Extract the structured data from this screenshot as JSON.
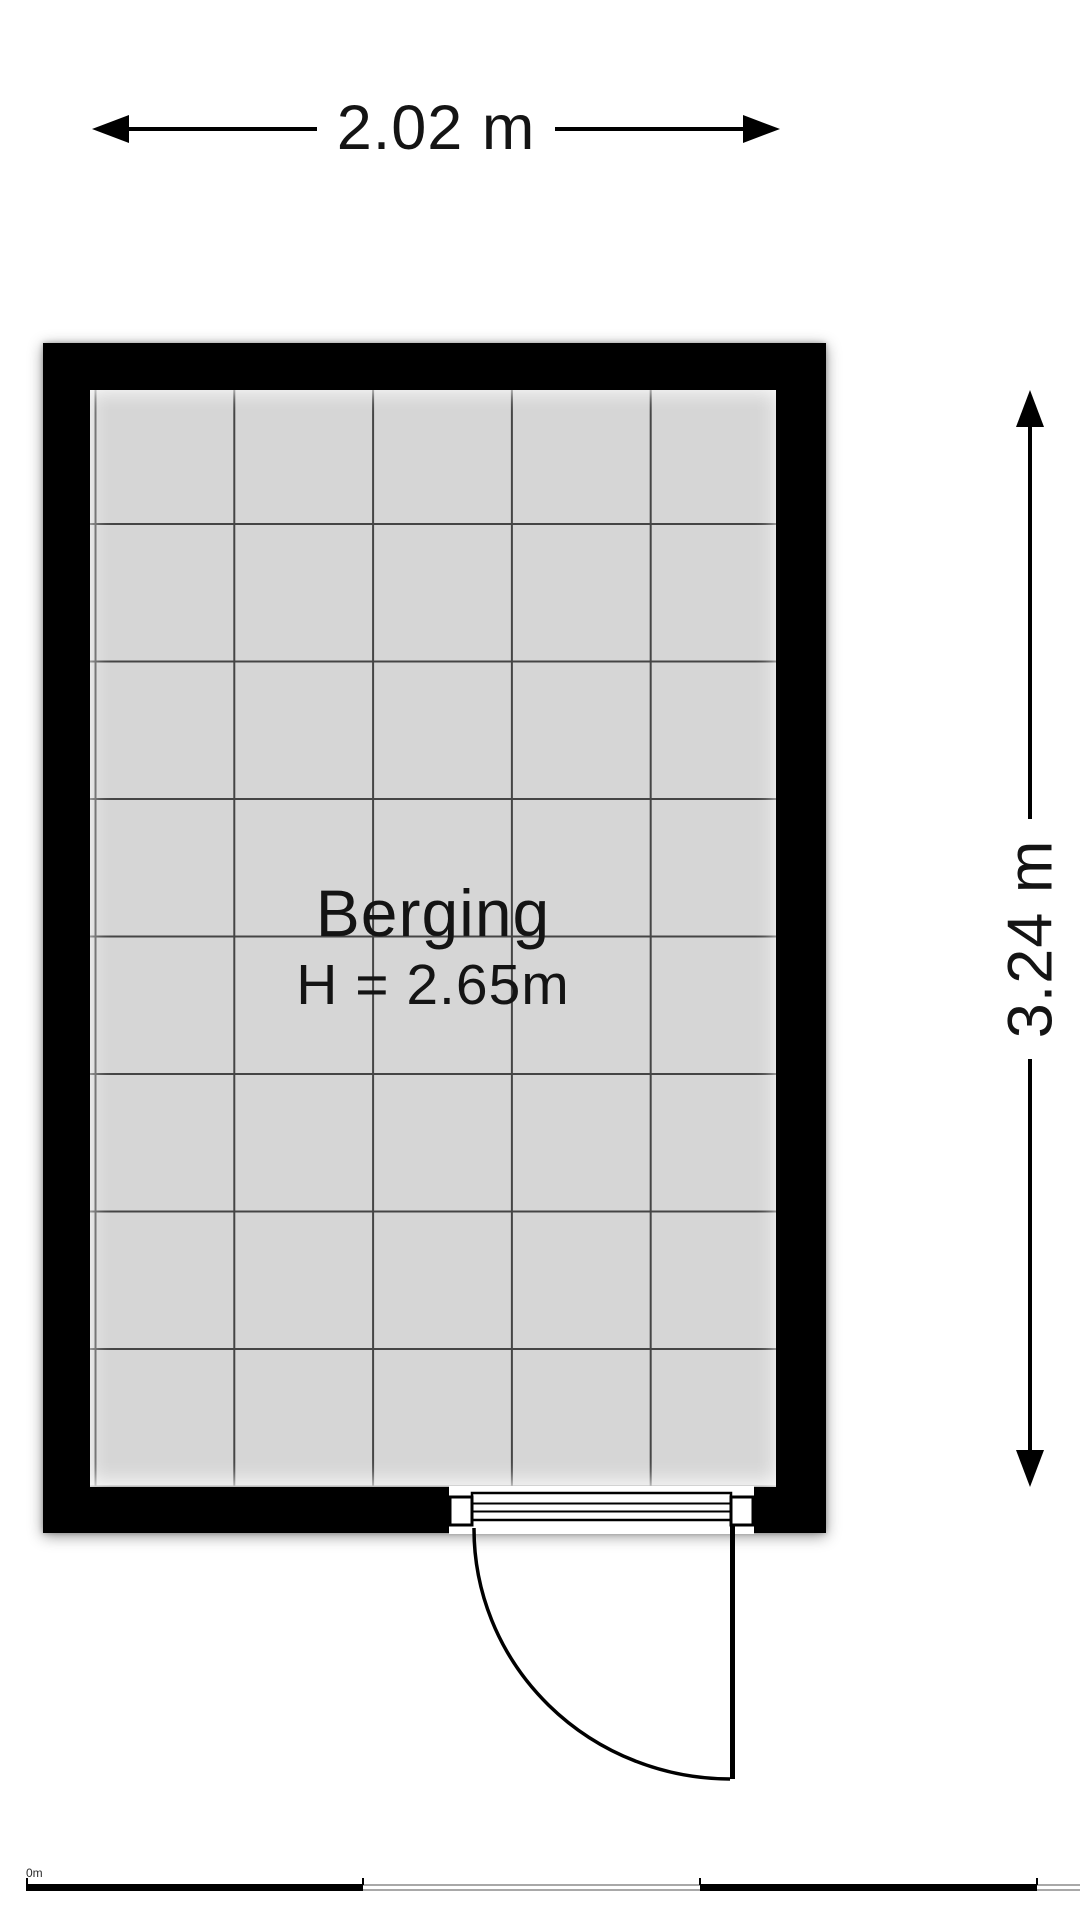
{
  "plan": {
    "room": {
      "name": "Berging",
      "ceiling_height_label": "H = 2.65m"
    },
    "dimensions": {
      "width_label": "2.02 m",
      "depth_label": "3.24 m"
    },
    "scale_bar": {
      "origin_label": "0m"
    },
    "colors": {
      "wall": "#000000",
      "floor": "#d6d6d6",
      "grid_line": "#454545",
      "text": "#141414",
      "scale_bar_outline": "#a8a8a8"
    }
  }
}
